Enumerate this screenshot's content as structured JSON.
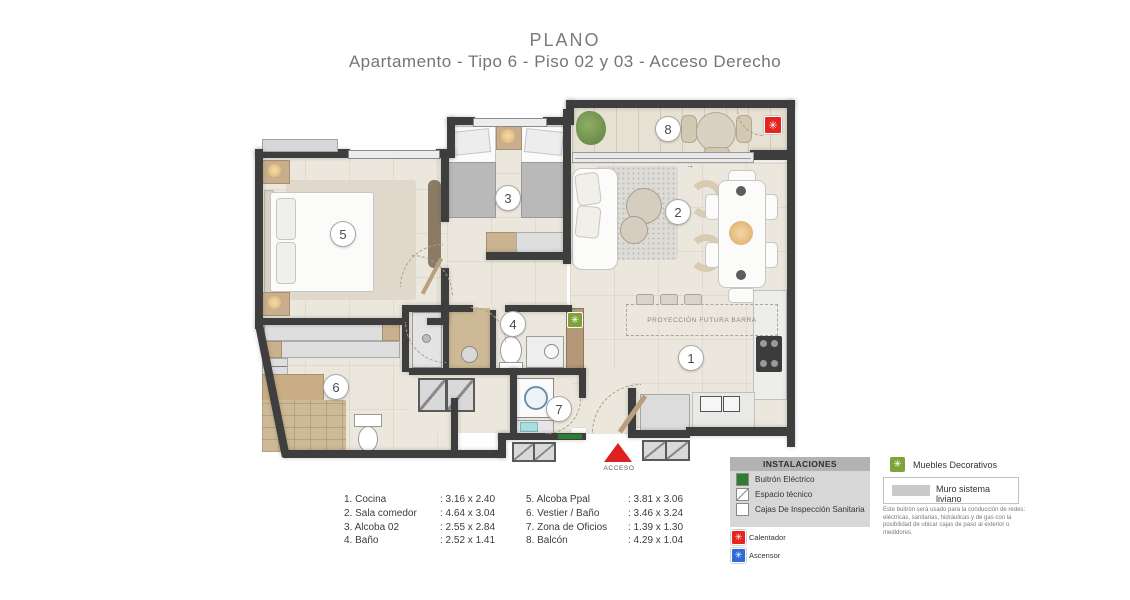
{
  "title": "PLANO",
  "subtitle": "Apartamento - Tipo 6  - Piso 02 y 03  -  Acceso Derecho",
  "icons": {
    "asterisk": "✳",
    "arrow_right": "→"
  },
  "plan": {
    "acceso": "ACCESO",
    "proyeccion": "PROYECCIÓN FUTURA BARRA"
  },
  "rooms": [
    {
      "n": "1",
      "list_label": "1. Cocina",
      "dims": ": 3.16 x 2.40"
    },
    {
      "n": "2",
      "list_label": "2. Sala comedor",
      "dims": ": 4.64 x 3.04"
    },
    {
      "n": "3",
      "list_label": "3. Alcoba 02",
      "dims": ": 2.55 x 2.84"
    },
    {
      "n": "4",
      "list_label": "4. Baño",
      "dims": ": 2.52 x 1.41"
    },
    {
      "n": "5",
      "list_label": "5. Alcoba Ppal",
      "dims": ": 3.81 x 3.06"
    },
    {
      "n": "6",
      "list_label": "6. Vestier / Baño",
      "dims": ": 3.46 x 3.24"
    },
    {
      "n": "7",
      "list_label": "7. Zona de Oficios",
      "dims": ": 1.39 x 1.30"
    },
    {
      "n": "8",
      "list_label": "8. Balcón",
      "dims": ": 4.29 x 1.04"
    }
  ],
  "instalaciones": {
    "title": "INSTALACIONES",
    "items": [
      "Buitrón Eléctrico",
      "Espacio técnico",
      "Cajas De Inspección Sanitaria"
    ]
  },
  "legend": {
    "muebles": "Muebles Decorativos",
    "muro": "Muro sistema liviano",
    "nota": "Este buitrón será usado para la conducción de redes: eléctricas, sanitarias, hidráulicas y de gas con la posibilidad de ubicar cajas de paso al exterior o medidores.",
    "calentador": "Calentador",
    "ascensor": "Ascensor"
  },
  "colors": {
    "wall": "#3e3e3e",
    "floor": "#ebe7dc",
    "accent_red": "#e3251d",
    "buitron_green": "#2f7d33",
    "muebles_green": "#7da33b",
    "ascensor_blue": "#2e6bd8"
  }
}
